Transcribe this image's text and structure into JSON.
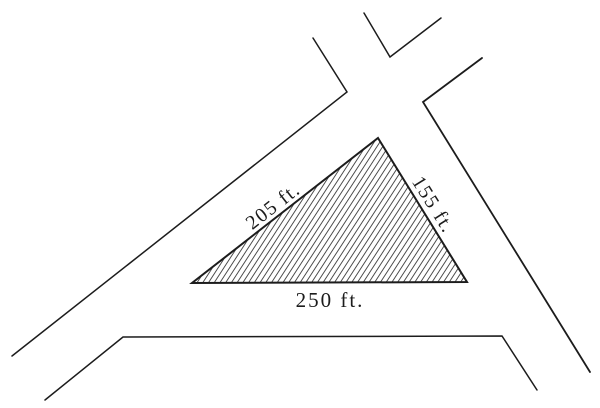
{
  "diagram": {
    "kind": "triangular-corner-lot-plat",
    "triangle": {
      "sides": [
        {
          "name": "northwest-side",
          "label": "205 ft."
        },
        {
          "name": "east-side",
          "label": "155 ft."
        },
        {
          "name": "south-side",
          "label": "250 ft."
        }
      ]
    },
    "colors": {
      "ink": "#1c1c1c",
      "hatch": "#3d3d3d",
      "paper": "#ffffff"
    }
  }
}
